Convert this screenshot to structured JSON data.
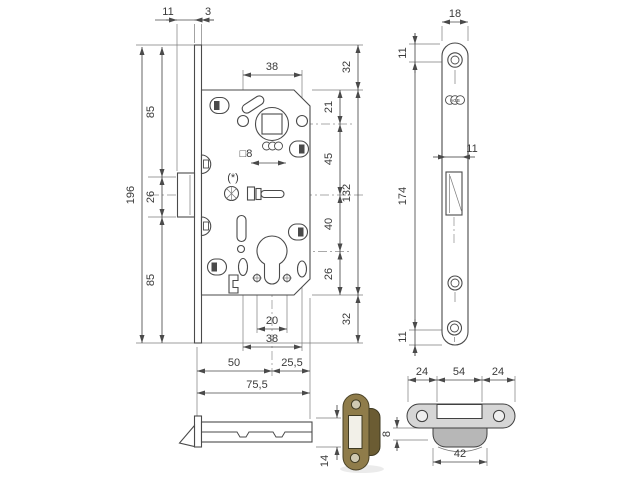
{
  "meta": {
    "subject": "Mortise door lock technical drawing with faceplate, side view and strike plate",
    "units": "mm"
  },
  "main_view": {
    "latch_protrusion": "11",
    "faceplate_thickness": "3",
    "height_top": "85",
    "latch_height": "26",
    "height_bottom": "85",
    "overall_height": "196",
    "spindle_hole_spacing": "38",
    "spindle_square": "□8",
    "note": "(*)",
    "top_to_spindle": "21",
    "spindle_to_latch": "45",
    "latch_to_cylinder": "40",
    "cylinder_to_bottom": "26",
    "overhang_top": "32",
    "body_height": "132",
    "overhang_bottom": "32",
    "cylinder_screw_spacing": "20",
    "lower_hole_spacing": "38",
    "backset": "50",
    "rear_section": "25,5",
    "case_depth": "75,5"
  },
  "faceplate_view": {
    "width": "18",
    "top_hole_offset": "11",
    "hole_spacing": "174",
    "latch_cutout_width": "11",
    "bottom_hole_offset": "11",
    "brand": "AGB"
  },
  "side_view": {
    "case_thickness": "14"
  },
  "strike_plate_view": {
    "section_left": "24",
    "section_center": "54",
    "section_right": "24",
    "lip_width": "42",
    "lip_offset": "8"
  },
  "colors": {
    "line": "#4a4a4a",
    "text": "#3a3a3a",
    "strike_fill": "#d6d6d6",
    "strike_lip_fill": "#b7b7b7",
    "bronze": "#8f7c4a",
    "bronze_dark": "#6b5c33"
  }
}
